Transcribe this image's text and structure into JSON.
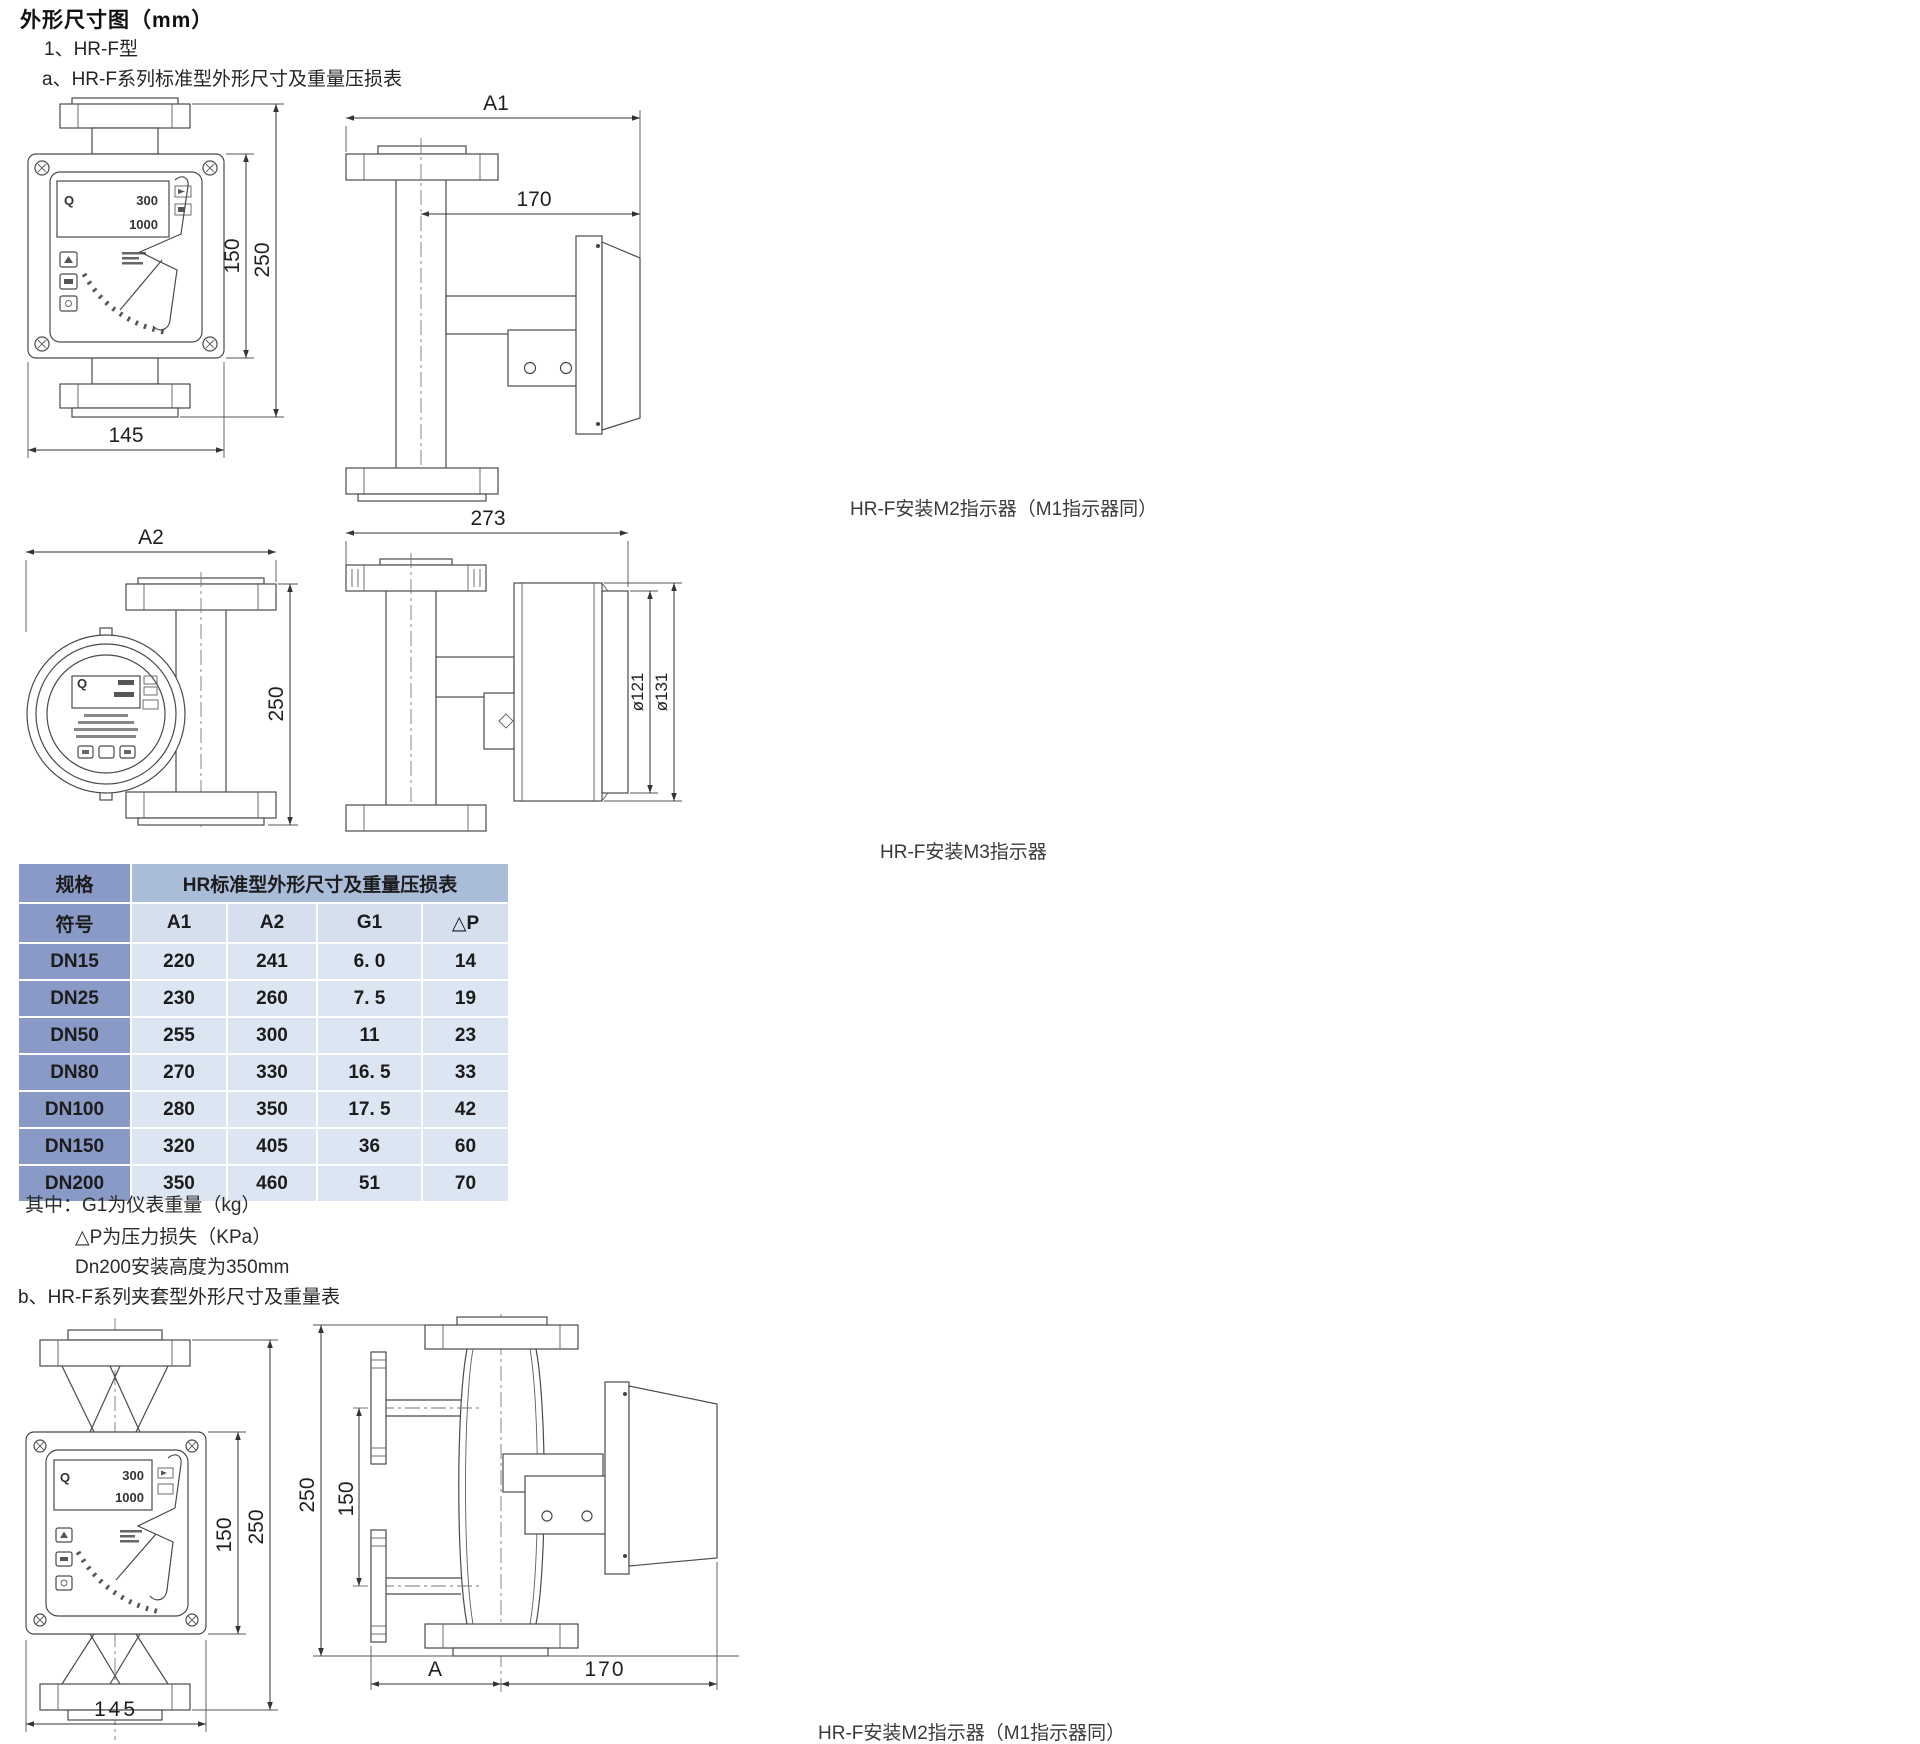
{
  "page": {
    "title": "外形尺寸图（mm）",
    "item1": "1、HR-F型",
    "item_a": "a、HR-F系列标准型外形尺寸及重量压损表",
    "item_b": "b、HR-F系列夹套型外形尺寸及重量表",
    "caption_m2_standard": "HR-F安装M2指示器（M1指示器同）",
    "caption_m3": "HR-F安装M3指示器",
    "caption_m2_jacket": "HR-F安装M2指示器（M1指示器同）"
  },
  "meter_face": {
    "q_label": "Q",
    "flow_value": "300",
    "total_value": "1000"
  },
  "dims": {
    "std_front": {
      "width": "145",
      "body_height": "150",
      "total_height": "250"
    },
    "std_side": {
      "length": "A1",
      "indicator_offset": "170"
    },
    "std_back": {
      "length": "A2",
      "total_height": "250"
    },
    "m3_side": {
      "length": "273",
      "dia_inner": "ø121",
      "dia_outer": "ø131"
    },
    "jacket_front": {
      "width": "145",
      "body_height": "150",
      "total_height": "250"
    },
    "jacket_side": {
      "total_height": "250",
      "port_span": "150",
      "length_a": "A",
      "indicator_offset": "170"
    }
  },
  "table": {
    "corner_header": "规格",
    "title_header": "HR标准型外形尺寸及重量压损表",
    "sub_headers": [
      "符号",
      "A1",
      "A2",
      "G1",
      "△P"
    ],
    "rows": [
      {
        "spec": "DN15",
        "a1": "220",
        "a2": "241",
        "g1": "6. 0",
        "dp": "14"
      },
      {
        "spec": "DN25",
        "a1": "230",
        "a2": "260",
        "g1": "7. 5",
        "dp": "19"
      },
      {
        "spec": "DN50",
        "a1": "255",
        "a2": "300",
        "g1": "11",
        "dp": "23"
      },
      {
        "spec": "DN80",
        "a1": "270",
        "a2": "330",
        "g1": "16. 5",
        "dp": "33"
      },
      {
        "spec": "DN100",
        "a1": "280",
        "a2": "350",
        "g1": "17. 5",
        "dp": "42"
      },
      {
        "spec": "DN150",
        "a1": "320",
        "a2": "405",
        "g1": "36",
        "dp": "60"
      },
      {
        "spec": "DN200",
        "a1": "350",
        "a2": "460",
        "g1": "51",
        "dp": "70"
      }
    ],
    "notes": [
      "其中：G1为仪表重量（kg）",
      "△P为压力损失（KPa）",
      "Dn200安装高度为350mm"
    ]
  }
}
